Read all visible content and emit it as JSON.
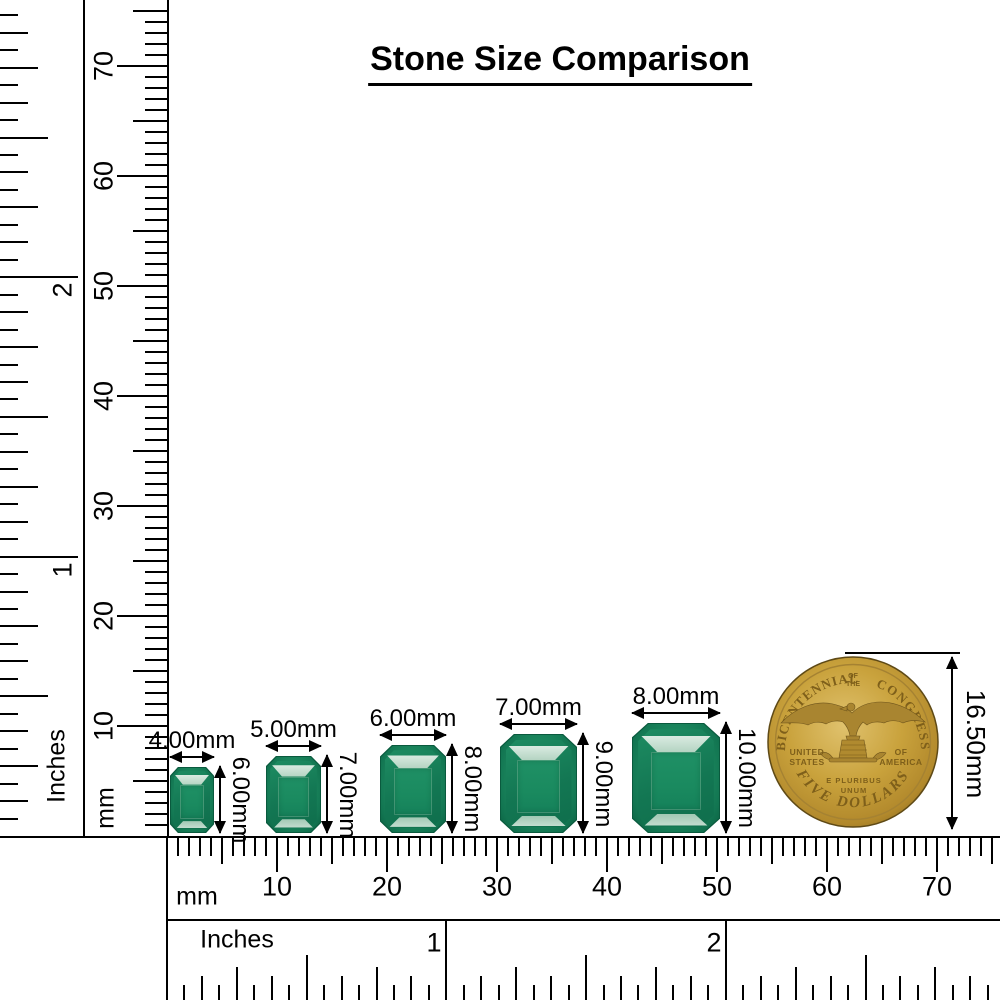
{
  "title": "Stone Size Comparison",
  "rulers": {
    "left_inches": {
      "unit": "Inches",
      "numbers": [
        "1",
        "2"
      ]
    },
    "left_mm": {
      "unit": "mm",
      "numbers": [
        "10",
        "20",
        "30",
        "40",
        "50",
        "60",
        "70"
      ]
    },
    "bottom_mm": {
      "unit": "mm",
      "numbers": [
        "10",
        "20",
        "30",
        "40",
        "50",
        "60",
        "70"
      ]
    },
    "bottom_inches": {
      "unit": "Inches",
      "numbers": [
        "1",
        "2"
      ]
    }
  },
  "stones": [
    {
      "width_label": "4.00mm",
      "height_label": "6.00mm",
      "width_mm": 4,
      "height_mm": 6
    },
    {
      "width_label": "5.00mm",
      "height_label": "7.00mm",
      "width_mm": 5,
      "height_mm": 7
    },
    {
      "width_label": "6.00mm",
      "height_label": "8.00mm",
      "width_mm": 6,
      "height_mm": 8
    },
    {
      "width_label": "7.00mm",
      "height_label": "9.00mm",
      "width_mm": 7,
      "height_mm": 9
    },
    {
      "width_label": "8.00mm",
      "height_label": "10.00mm",
      "width_mm": 8,
      "height_mm": 10
    }
  ],
  "stone_colors": {
    "body": "#178a5f",
    "edge": "#0a5a3e",
    "table": "#1f9065",
    "flash": "#e3f0e7"
  },
  "coin": {
    "arc_left": "BICENTENNIAL",
    "top_small_line1": "OF",
    "top_small_line2": "THE",
    "arc_right": "CONGRESS",
    "left_line1": "UNITED",
    "left_line2": "STATES",
    "right_line1": "OF",
    "right_line2": "AMERICA",
    "motto_line1": "E PLURIBUS",
    "motto_line2": "UNUM",
    "bottom_arc": "FIVE DOLLARS",
    "size_label": "16.50mm",
    "colors": {
      "gold": "#c9a23c",
      "gold_light": "#dfc06a",
      "gold_dark": "#8f6f22",
      "lettering": "#7e5f1a"
    }
  }
}
